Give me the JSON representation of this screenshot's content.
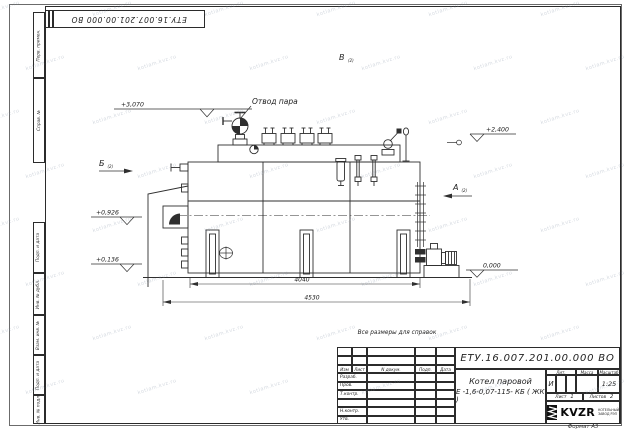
{
  "sheet": {
    "top_stamp": "ЕТУ.16.007.201.00.000  ВО",
    "note": "Все размеры для справок",
    "format_label": "Формат А3",
    "watermark": "kotlam.kvz.ru"
  },
  "margin": {
    "perv_primen": "Перв. примен.",
    "sprav_no": "Справ. №",
    "podp_data_1": "Подп. и дата",
    "inv_dubl": "Инв. № дубл.",
    "vzam_inv": "Взам. инв. №",
    "podp_data_2": "Подп. и дата",
    "inv_podl": "Инв. № подл."
  },
  "drawing": {
    "steam_outlet_label": "Отвод пара",
    "view_v": "В",
    "view_b": "Б",
    "view_a": "А",
    "view_ref": "(2)",
    "elev_3070": "+3,070",
    "elev_2400": "+2,400",
    "elev_0926": "+0,926",
    "elev_0136": "+0,136",
    "elev_0000": "0,000",
    "dim_inner": "4040",
    "dim_outer": "4530"
  },
  "title_block": {
    "doc_number": "ЕТУ.16.007.201.00.000  ВО",
    "product_line1": "Котел паровой",
    "product_line2": "Е -1,6-0,07-115- КБ ( ЖК )",
    "col_izm": "Изм",
    "col_list": "Лист",
    "col_doc": "N докум.",
    "col_podp": "Подп.",
    "col_data": "Дата",
    "row_razrab": "Разраб.",
    "row_prov": "Пров.",
    "row_tkontr": "Т.контр.",
    "row_nkontr": "Н.контр.",
    "row_utv": "Утв.",
    "lit_label": "Лит.",
    "lit_value": "И",
    "mass_label": "Масса",
    "scale_label": "Масштаб",
    "scale_value": "1:25",
    "sheet_label": "Лист",
    "sheet_value": "1",
    "sheets_label": "Листов",
    "sheets_value": "2",
    "logo_text": "KVZR",
    "logo_caption1": "КОТЕЛЬНЫЙ",
    "logo_caption2": "ЗАВОД РЭП"
  }
}
